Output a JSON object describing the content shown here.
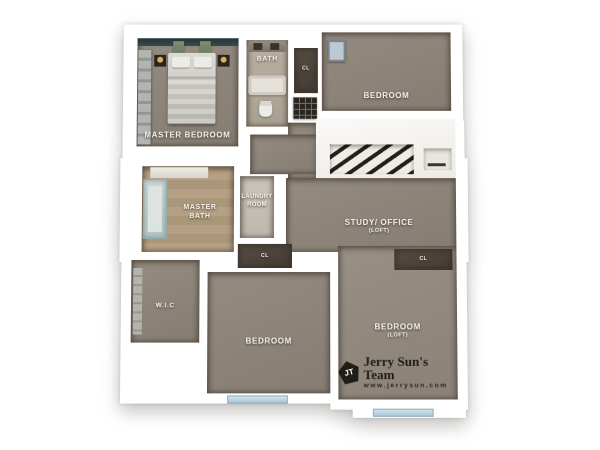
{
  "title": "3D second-floor real estate floor plan rendering",
  "rooms": {
    "master_bedroom": {
      "label": "MASTER BEDROOM"
    },
    "bath": {
      "label": "BATH"
    },
    "bedroom_top": {
      "label": "BEDROOM"
    },
    "study_office": {
      "label": "STUDY/ OFFICE",
      "sublabel": "(LOFT)"
    },
    "master_bath": {
      "label": "MASTER BATH"
    },
    "laundry": {
      "label": "LAUNDRY ROOM"
    },
    "wic": {
      "label": "W.I.C"
    },
    "bedroom_bottom": {
      "label": "BEDROOM"
    },
    "bedroom_loft": {
      "label": "BEDROOM",
      "sublabel": "(LOFT)"
    },
    "closet_top": {
      "label": "CL"
    },
    "closet_hall": {
      "label": "CL"
    },
    "closet_bedroom_loft": {
      "label": "CL"
    }
  },
  "branding": {
    "badge_initials": "JT",
    "team_name": "Jerry Sun's Team",
    "website": "www.jerrysun.com"
  },
  "colors": {
    "background": "#ffffff",
    "walls": "#ffffff",
    "carpet": "#8b8177",
    "bath_tile": "#b3a99b",
    "travertine_tile": "#b29d82",
    "laundry_tile": "#c6c0b6",
    "closet_dark": "#4c443c",
    "accent_wall_teal": "#3a4a4c",
    "window_glass": "#bfd9e7",
    "lamp_gold": "#d9b35c",
    "logo_black": "#201c18",
    "label_text": "#f6f4f0"
  }
}
